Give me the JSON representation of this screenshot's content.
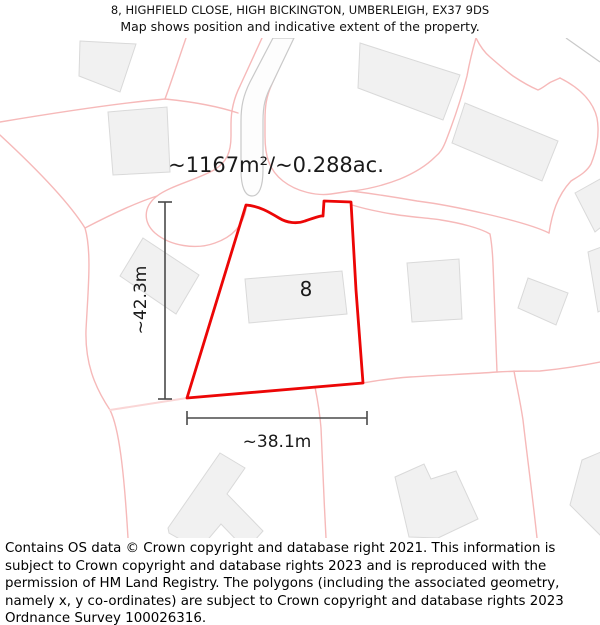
{
  "title": {
    "line1": "8, HIGHFIELD CLOSE, HIGH BICKINGTON, UMBERLEIGH, EX37 9DS",
    "line2": "Map shows position and indicative extent of the property."
  },
  "map": {
    "area_label": "~1167m²/~0.288ac.",
    "plot_number": "8",
    "height_label": "~42.3m",
    "width_label": "~38.1m",
    "colors": {
      "plot_outline": "#ec0606",
      "boundary": "#f6b9b9",
      "boundary_light": "#fad6d6",
      "building_fill": "#f1f1f1",
      "building_stroke": "#d9d9d9",
      "road_edge": "#c9c9c9",
      "dimension": "#4a4a4a"
    }
  },
  "footer": {
    "text": "Contains OS data © Crown copyright and database right 2021. This information is subject to Crown copyright and database rights 2023 and is reproduced with the permission of HM Land Registry. The polygons (including the associated geometry, namely x, y co-ordinates) are subject to Crown copyright and database rights 2023 Ordnance Survey 100026316."
  }
}
